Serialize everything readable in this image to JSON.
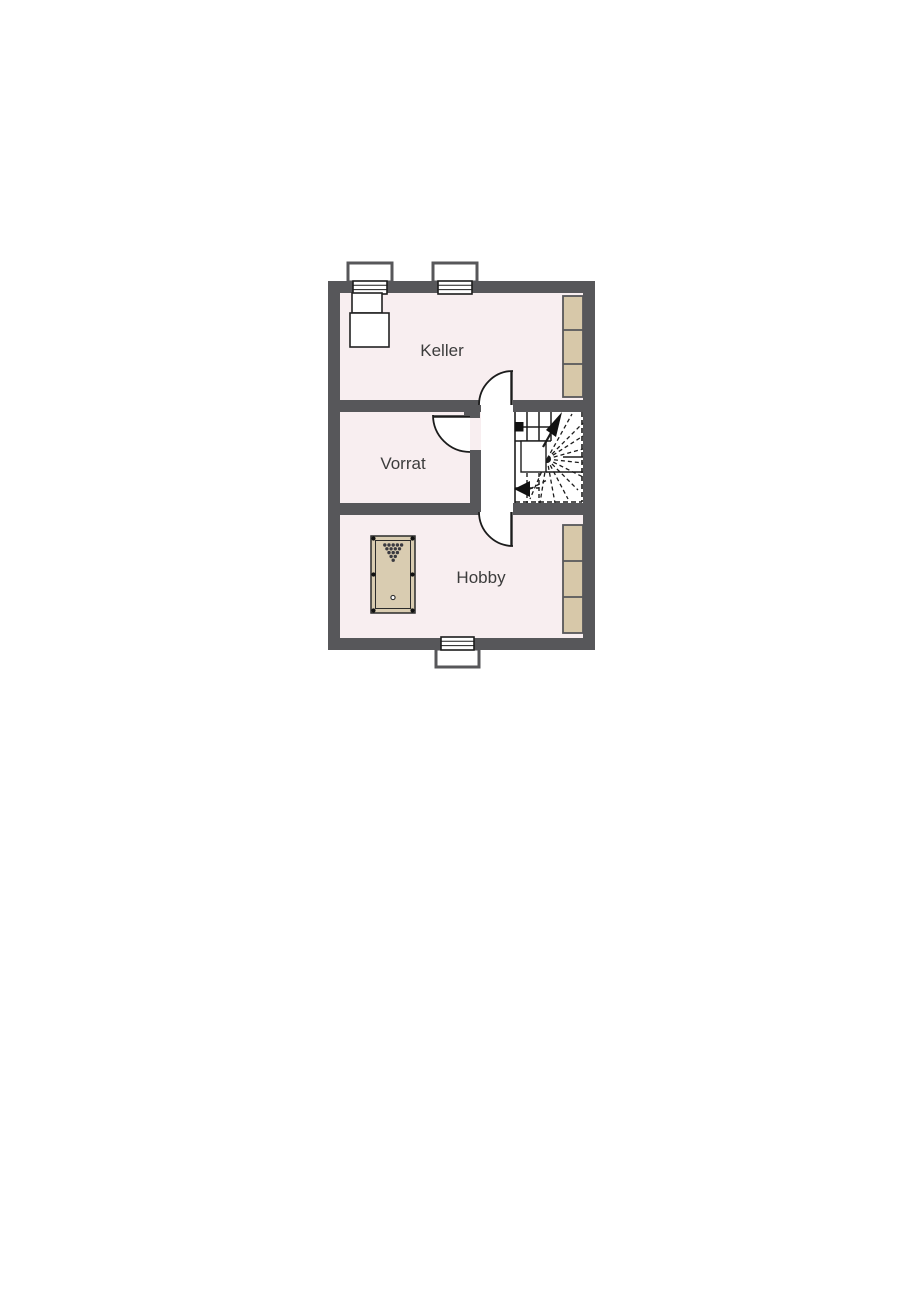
{
  "title": "Basement floor plan",
  "colors": {
    "background": "#ffffff",
    "wall": "#57575a",
    "room_fill": "#f8eef0",
    "hall_fill": "#ffffff",
    "furniture_tan": "#d7c8a9",
    "table_tan": "#d9ccb1",
    "line": "#1c1c1c",
    "label": "#3c3c3c"
  },
  "rooms": [
    {
      "name": "Keller"
    },
    {
      "name": "Vorrat"
    },
    {
      "name": "Hobby"
    }
  ],
  "fixtures": [
    "window-top-left",
    "window-top-right",
    "window-bottom",
    "cabinet-under-window",
    "shelves-keller",
    "shelves-hobby",
    "door-keller",
    "door-vorrat",
    "door-hobby",
    "winder-staircase",
    "billiard-table"
  ]
}
